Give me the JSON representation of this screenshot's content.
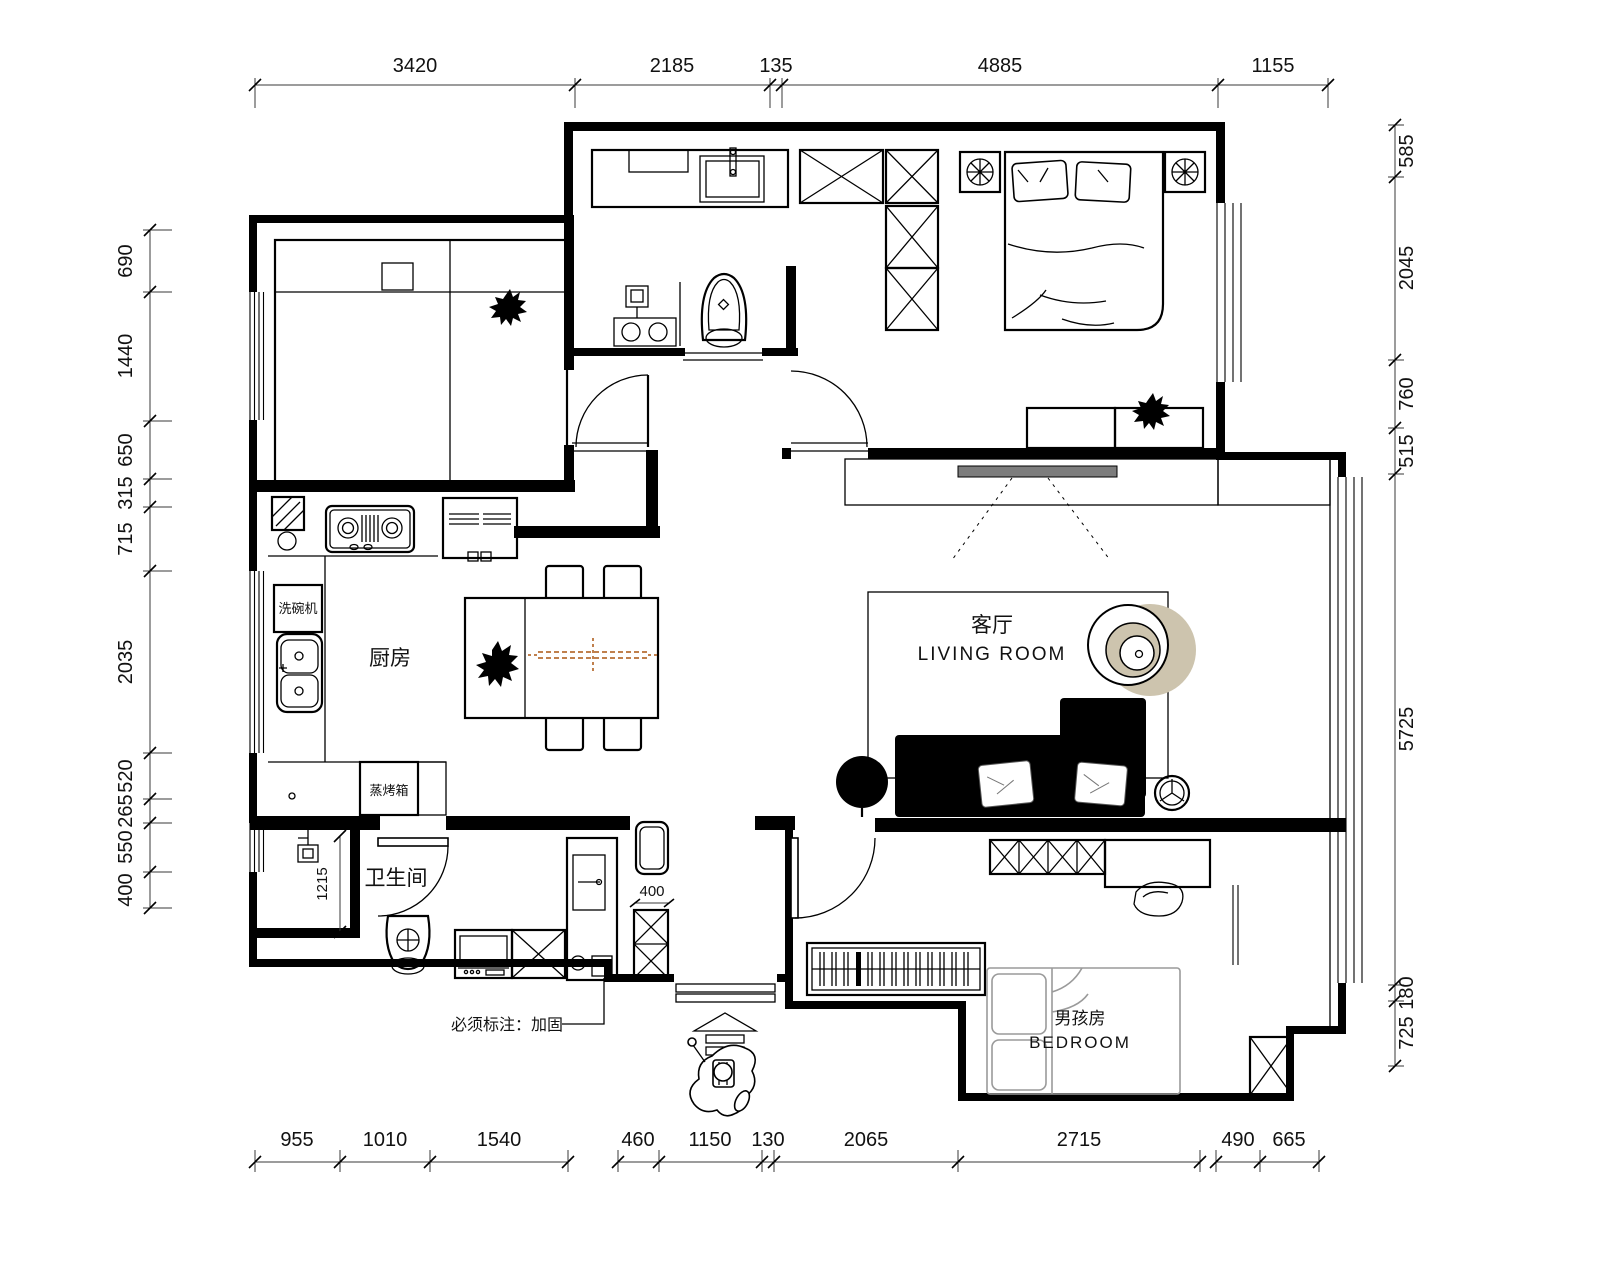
{
  "dimensions": {
    "top": [
      "3420",
      "2185",
      "135",
      "4885",
      "1155"
    ],
    "left": [
      "690",
      "1440",
      "650",
      "315",
      "715",
      "2035",
      "520",
      "265",
      "550",
      "400"
    ],
    "right": [
      "585",
      "2045",
      "760",
      "515",
      "5725",
      "180",
      "725"
    ],
    "bottom_left": [
      "955",
      "1010",
      "1540"
    ],
    "bottom_center": [
      "460",
      "1150",
      "130",
      "2065",
      "2715"
    ],
    "bottom_right": [
      "490",
      "665"
    ]
  },
  "rooms": {
    "kitchen": {
      "label": "厨房"
    },
    "bathroom": {
      "label": "卫生间"
    },
    "living": {
      "label_cn": "客厅",
      "label_en": "LIVING ROOM"
    },
    "boys_bedroom": {
      "label_cn": "男孩房",
      "label_en": "BEDROOM"
    }
  },
  "appliances": {
    "dishwasher": "洗碗机",
    "steam_oven": "蒸烤箱"
  },
  "annotations": {
    "reinforce_note": "必须标注：加固",
    "niche_depth": "1215",
    "cabinet_width": "400"
  },
  "colors": {
    "tv": "#7d7d7d",
    "accent_tan": "#cdc4ae",
    "table_runner": "#c0804d",
    "bed_outline": "#9a9a9a"
  }
}
